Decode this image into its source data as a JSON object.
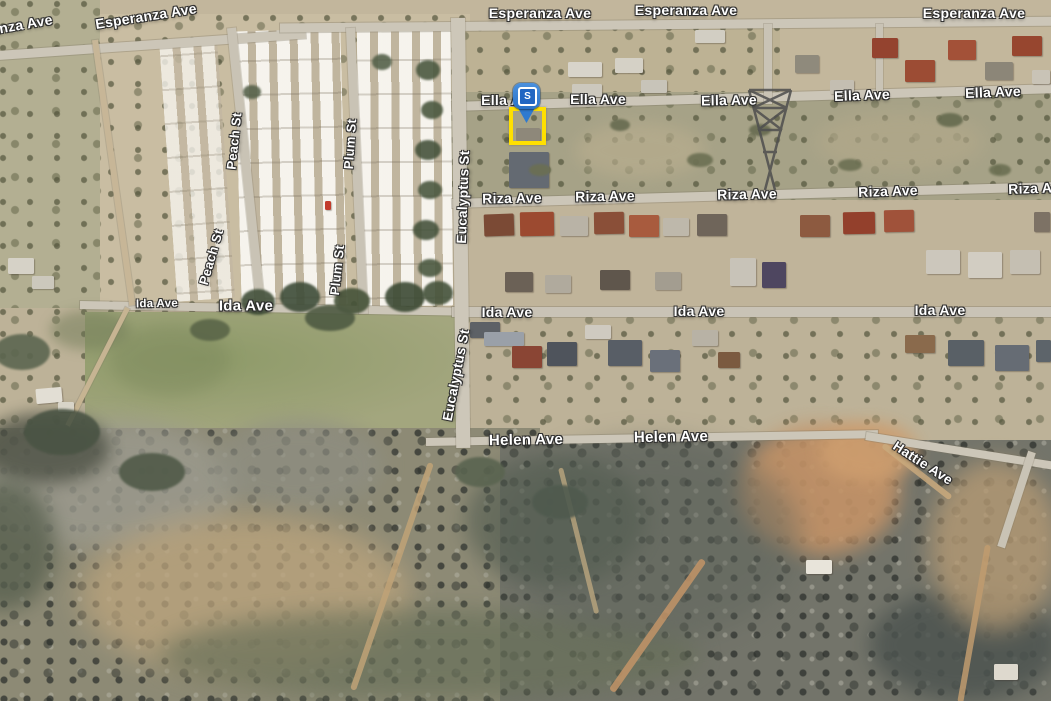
{
  "map": {
    "streets": {
      "esperanza": "Esperanza Ave",
      "ella": "Ella Ave",
      "riza": "Riza Ave",
      "ida": "Ida Ave",
      "helen": "Helen Ave",
      "hattie": "Hattie Ave",
      "eucalyptus": "Eucalyptus St",
      "plum": "Plum St",
      "peach": "Peach St"
    },
    "marker": {
      "label": "S",
      "pin_color": "#2e7ad0",
      "badge_color": "#2166c2",
      "highlight_color": "#ffe000"
    }
  }
}
